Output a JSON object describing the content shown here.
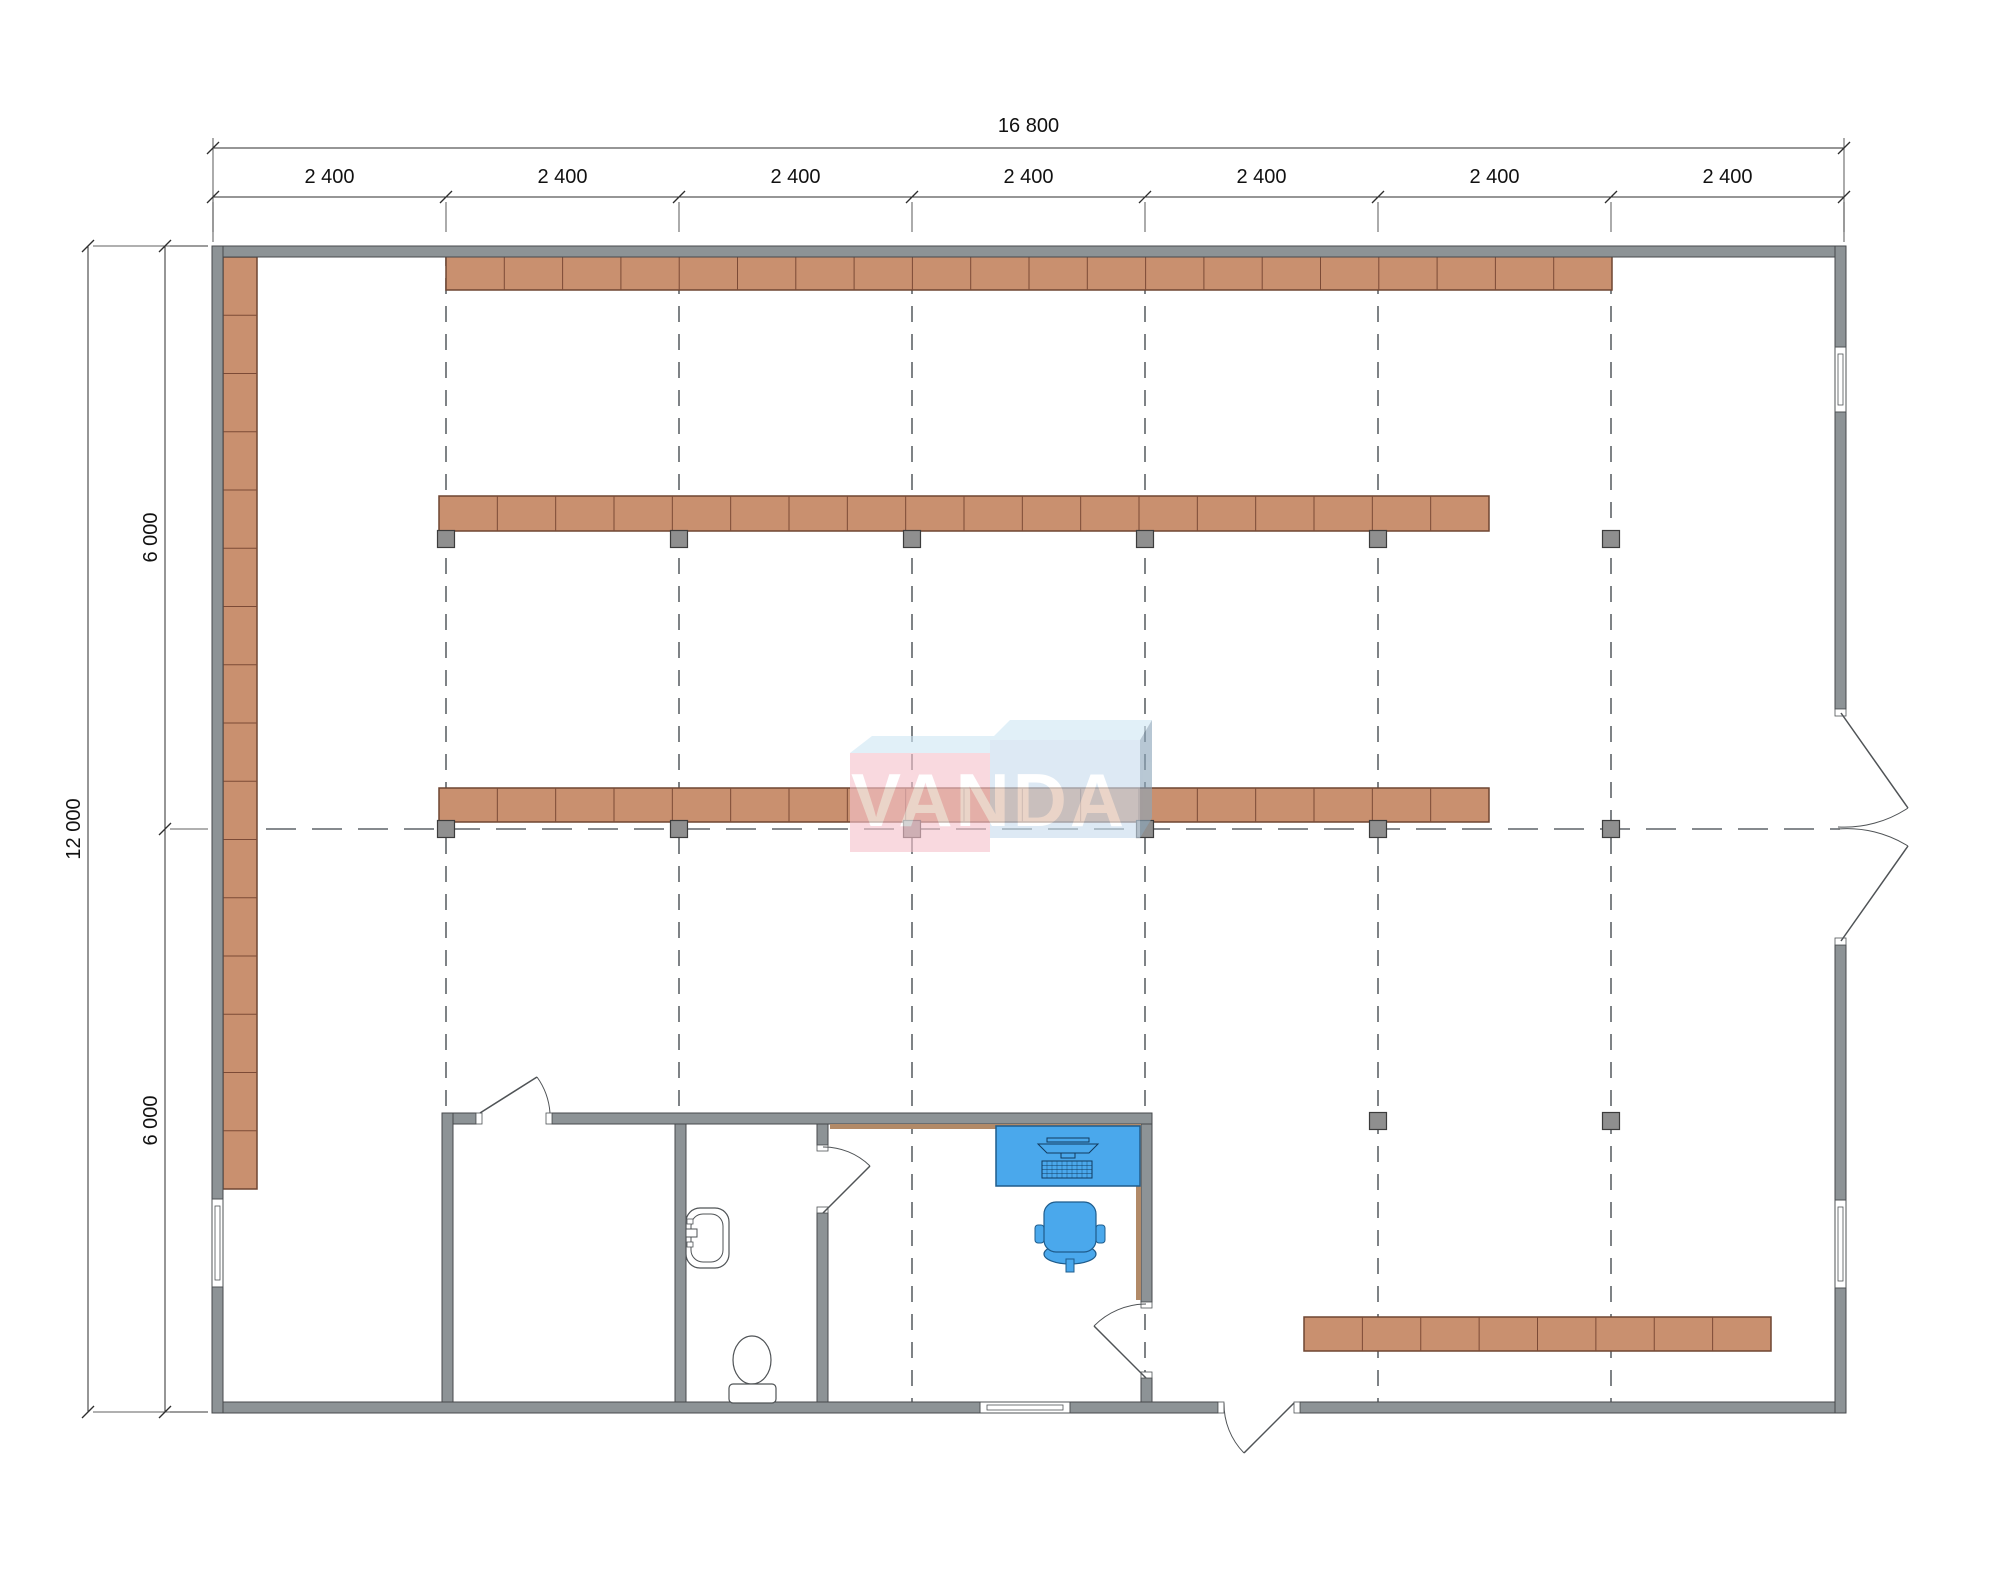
{
  "watermark": {
    "text": "VANDA"
  },
  "dimensions": {
    "top": {
      "total_label": "16 800",
      "segment_labels": [
        "2 400",
        "2 400",
        "2 400",
        "2 400",
        "2 400",
        "2 400",
        "2 400"
      ]
    },
    "left": {
      "total_label": "12 000",
      "segment_labels": [
        "6 000",
        "6 000"
      ]
    }
  },
  "colors": {
    "wall": "#8d9396",
    "wall_border": "#47494c",
    "shelf": "#c9906f",
    "shelf_border": "#6f4632",
    "shelf_divider": "#7c4a36",
    "column": "#8f8f8f",
    "column_border": "#3c3c3c",
    "dash": "#5f6468",
    "line": "#4f5356",
    "dim": "#2e2e2e",
    "dim_text": "#111111",
    "furniture": "#4aa8ec",
    "furniture_border": "#1f5c8c",
    "tan": "#b28a68",
    "logo_pink": "#f6c3cc",
    "logo_blue_top": "#cfe7f5",
    "logo_blue": "#c9ddee",
    "logo_blue_dark": "#8ca6ba",
    "logo_text": "#ffffff"
  },
  "plan": {
    "canvas": {
      "w": 2000,
      "h": 1574
    },
    "grid": {
      "verticals": {
        "xs": [
          446,
          679,
          912,
          1145,
          1378,
          1611
        ],
        "y1": 250,
        "y2": 1408,
        "dash": "16 12"
      },
      "horizontal": {
        "y": 829,
        "x1": 220,
        "x2": 1840,
        "dash": "30 16"
      }
    },
    "ext_walls": [
      [
        212,
        246,
        1634,
        11
      ],
      [
        212,
        1402,
        768,
        11
      ],
      [
        1070,
        1402,
        148,
        11
      ],
      [
        1300,
        1402,
        546,
        11
      ],
      [
        212,
        246,
        11,
        953
      ],
      [
        212,
        1287,
        11,
        126
      ],
      [
        1835,
        246,
        11,
        101
      ],
      [
        1835,
        412,
        11,
        297
      ],
      [
        1835,
        945,
        11,
        255
      ],
      [
        1835,
        1288,
        11,
        125
      ]
    ],
    "int_walls": [
      [
        442,
        1113,
        34,
        11
      ],
      [
        552,
        1113,
        600,
        11
      ],
      [
        442,
        1113,
        11,
        289
      ],
      [
        675,
        1124,
        11,
        278
      ],
      [
        817,
        1124,
        11,
        21
      ],
      [
        817,
        1213,
        11,
        189
      ],
      [
        1141,
        1124,
        11,
        178
      ],
      [
        1141,
        1378,
        11,
        24
      ]
    ],
    "tan_lines": [
      [
        830,
        1126.5,
        1139,
        1126.5
      ],
      [
        1138.5,
        1124,
        1138.5,
        1300
      ]
    ],
    "jambs": [
      [
        476,
        1113,
        6,
        11
      ],
      [
        546,
        1113,
        6,
        11
      ],
      [
        817,
        1145,
        11,
        6
      ],
      [
        817,
        1207,
        11,
        6
      ],
      [
        1141,
        1302,
        11,
        6
      ],
      [
        1141,
        1372,
        11,
        6
      ],
      [
        1218,
        1402,
        6,
        11
      ],
      [
        1294,
        1402,
        6,
        11
      ],
      [
        1835,
        709,
        11,
        7
      ],
      [
        1835,
        938,
        11,
        7
      ]
    ],
    "windows": [
      {
        "rect": [
          212,
          1199,
          11,
          88
        ],
        "inner": [
          215,
          1206,
          5,
          74
        ]
      },
      {
        "rect": [
          1835,
          347,
          11,
          65
        ],
        "inner": [
          1838,
          354,
          5,
          51
        ]
      },
      {
        "rect": [
          1835,
          1200,
          11,
          88
        ],
        "inner": [
          1838,
          1207,
          5,
          74
        ]
      },
      {
        "rect": [
          980,
          1402,
          90,
          11
        ],
        "inner": [
          987,
          1405,
          76,
          5
        ]
      }
    ],
    "shelves": [
      {
        "x": 446,
        "y": 255,
        "w": 1166,
        "h": 35,
        "segments": 20,
        "dir": "h"
      },
      {
        "x": 439,
        "y": 496,
        "w": 1050,
        "h": 35,
        "segments": 18,
        "dir": "h"
      },
      {
        "x": 439,
        "y": 788,
        "w": 1050,
        "h": 34,
        "segments": 18,
        "dir": "h"
      },
      {
        "x": 223,
        "y": 257,
        "w": 34,
        "h": 932,
        "segments": 16,
        "dir": "v"
      },
      {
        "x": 1304,
        "y": 1317,
        "w": 467,
        "h": 34,
        "segments": 8,
        "dir": "h"
      }
    ],
    "columns": [
      [
        446,
        539
      ],
      [
        679,
        539
      ],
      [
        912,
        539
      ],
      [
        1145,
        539
      ],
      [
        1378,
        539
      ],
      [
        1611,
        539
      ],
      [
        446,
        829
      ],
      [
        679,
        829
      ],
      [
        912,
        829
      ],
      [
        1145,
        829
      ],
      [
        1378,
        829
      ],
      [
        1611,
        829
      ],
      [
        1378,
        1121
      ],
      [
        1611,
        1121
      ]
    ],
    "doors": [
      {
        "name": "storage-door",
        "leaf": "M480,1113 L537,1077",
        "arc": "M537,1077 A70,70 0 0 1 550,1113"
      },
      {
        "name": "bathroom-door",
        "leaf": "M823,1213 L870,1166",
        "arc": "M823,1147 A66,66 0 0 1 870,1166"
      },
      {
        "name": "office-door",
        "leaf": "M1146,1378 L1094,1326",
        "arc": "M1146,1304 A74,74 0 0 0 1094,1326"
      },
      {
        "name": "entry-door",
        "leaf": "M1294,1403 L1244,1453",
        "arc": "M1224,1403 A70,70 0 0 0 1244,1453"
      },
      {
        "name": "double-door-top",
        "leaf": "M1841,713 L1908,808",
        "arc": "M1908,808 A115,115 0 0 1 1838,827"
      },
      {
        "name": "double-door-bottom",
        "leaf": "M1841,941 L1908,846",
        "arc": "M1908,846 A115,115 0 0 0 1838,829"
      }
    ],
    "furniture": {
      "desk": {
        "rect": [
          996,
          1126,
          144,
          60
        ]
      },
      "monitor": {
        "screen": [
          1047,
          1138,
          42,
          4
        ],
        "body": "M1038,1144 L1098,1144 L1089,1153 L1047,1153 Z",
        "stand": [
          1061,
          1153,
          14,
          5
        ]
      },
      "keyboard": {
        "rect": [
          1042,
          1161,
          50,
          17
        ]
      },
      "chair": {
        "seat": [
          1044,
          1202,
          52,
          50
        ],
        "arm_l": [
          1035,
          1225,
          9,
          18
        ],
        "arm_r": [
          1096,
          1225,
          9,
          18
        ],
        "base_cx": 1070,
        "base_cy": 1254,
        "base_rx": 26,
        "base_ry": 10,
        "stem": [
          1066,
          1259,
          8,
          13
        ]
      },
      "sink": {
        "outer": [
          686,
          1208,
          43,
          60
        ],
        "inner": [
          691,
          1214,
          32,
          48
        ],
        "faucet": [
          686,
          1229,
          11,
          8
        ],
        "h1": [
          687,
          1219,
          6,
          5
        ],
        "h2": [
          687,
          1242,
          6,
          5
        ]
      },
      "toilet": {
        "tank": [
          729,
          1384,
          47,
          19
        ],
        "bowl_cx": 752,
        "bowl_cy": 1360,
        "bowl_rx": 19,
        "bowl_ry": 24
      }
    },
    "logo": {
      "left_top": "850,753 990,753 1012,736 872,736",
      "left_face": [
        850,
        753,
        140,
        99
      ],
      "right_top": "990,740 1140,740 1152,720 1010,720",
      "right_face": [
        990,
        740,
        150,
        98
      ],
      "right_side": "1140,740 1152,720 1152,818 1140,838",
      "text_x": 989,
      "text_y": 826,
      "opacity": 0.62
    },
    "dims": {
      "top_ticks": [
        213,
        446,
        679,
        912,
        1145,
        1378,
        1611,
        1844
      ],
      "top_line1_y": 148,
      "top_line2_y": 197,
      "top_total_label_y": 132,
      "top_seg_label_y": 183,
      "left_ticks": [
        246,
        829,
        1412
      ],
      "left_line1_x": 88,
      "left_line2_x": 165,
      "left_total_label_x": 80,
      "left_seg_label_x": 157
    }
  }
}
